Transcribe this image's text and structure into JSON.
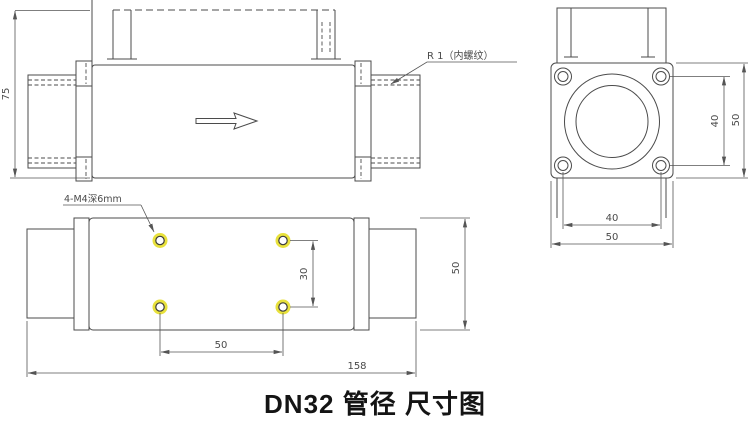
{
  "title": {
    "caption": "DN32 管径 尺寸图"
  },
  "colors": {
    "line": "#4b4b4b",
    "dim_text": "#4a4a4a",
    "hole_highlight": "#e8e13c",
    "caption_text": "#141414",
    "background": "#ffffff"
  },
  "views": {
    "side": {
      "dims": {
        "height": "75"
      },
      "annotations": {
        "thread": "R 1（内螺纹）"
      }
    },
    "end": {
      "dims": {
        "bolt_pitch_vertical": "40",
        "overall_height": "50",
        "bolt_pitch_horizontal": "40",
        "overall_width": "50"
      }
    },
    "bottom": {
      "annotations": {
        "tapped_holes": "4-M4深6mm"
      },
      "dims": {
        "hole_pitch_vertical": "30",
        "hole_pitch_horizontal": "50",
        "overall_length": "158",
        "overall_width": "50"
      }
    }
  }
}
